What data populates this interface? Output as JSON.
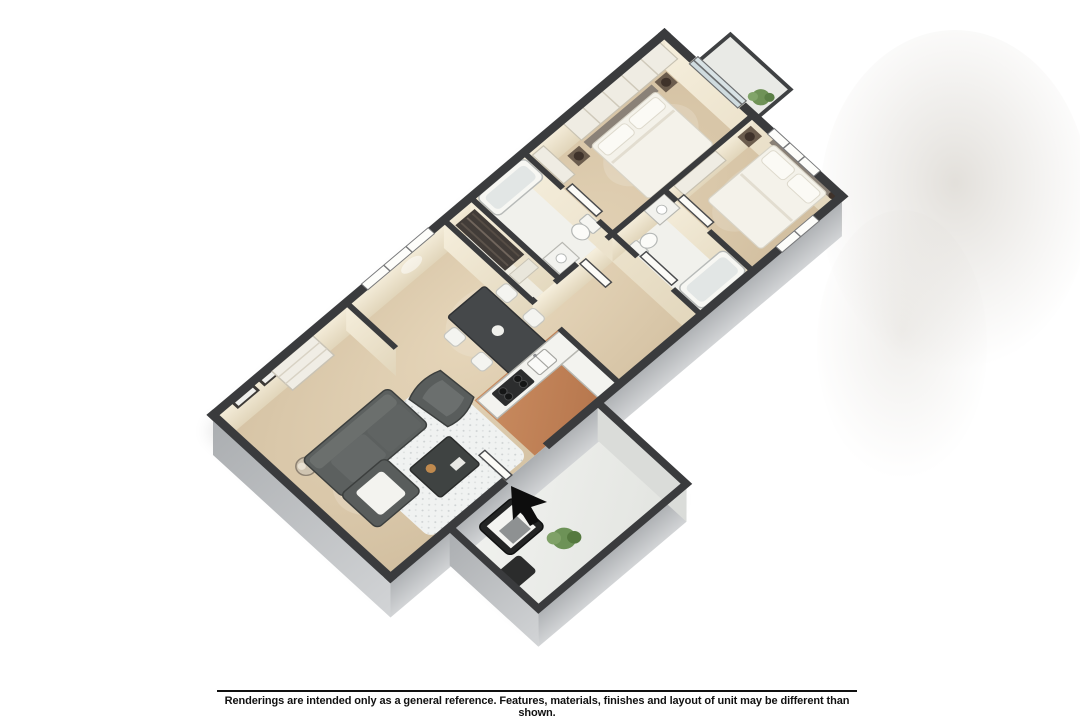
{
  "disclaimer": {
    "text": "Renderings are intended only as a general reference. Features, materials, finishes and layout of unit may be different than shown."
  },
  "floor_plan": {
    "view": "isometric-3d-cutaway-apartment",
    "bedrooms_visible": 2,
    "bathrooms_visible": 2,
    "rooms": [
      {
        "name": "living-room",
        "furniture": [
          "sectional-sofa",
          "accent-chair",
          "coffee-table",
          "area-rug",
          "globe-floor-lamp",
          "wall-art-frames",
          "console-shelf"
        ]
      },
      {
        "name": "dining-area",
        "furniture": [
          "dining-table",
          "dining-chairs-x4"
        ],
        "window": true
      },
      {
        "name": "kitchen",
        "furniture": [
          "l-shaped-counter",
          "cooktop",
          "double-sink"
        ],
        "floor": "terracotta-tile"
      },
      {
        "name": "hall-closet",
        "furniture": [
          "hanging-clothes",
          "linen-shelf"
        ]
      },
      {
        "name": "bathroom-1",
        "furniture": [
          "bathtub",
          "toilet",
          "vanity"
        ]
      },
      {
        "name": "bathroom-2",
        "furniture": [
          "bathtub",
          "toilet",
          "vanity"
        ]
      },
      {
        "name": "bedroom-1",
        "furniture": [
          "bed",
          "nightstands-x2",
          "sphere-lamps",
          "dresser",
          "closet-shelving",
          "sliding-glass-door"
        ]
      },
      {
        "name": "bedroom-2",
        "furniture": [
          "bed",
          "nightstand",
          "sphere-lamps",
          "dresser"
        ],
        "windows": 2
      },
      {
        "name": "patio",
        "furniture": [
          "lounge-chair",
          "ottoman",
          "potted-plant"
        ],
        "entry_marker": "cursor-arrow"
      },
      {
        "name": "balcony",
        "furniture": [
          "potted-plant"
        ],
        "railing": true
      }
    ]
  },
  "colors": {
    "background": "#ffffff",
    "wall_top": "#3a3b3d",
    "wall_face": "#e9dfca",
    "ext_wall": "#b5b8bb",
    "floor_tan": "#d8c5a6",
    "floor_tile": "#c08257",
    "floor_white": "#f1f1ec",
    "patio_floor": "#edefeb",
    "rug": "#f0f2f1",
    "sofa": "#5c605f",
    "dark_table": "#3f4342",
    "white_furniture": "#f3f3ef",
    "bed_linen": "#f4f2ea",
    "wood_dark": "#6b5c4d",
    "plant": "#6f9257",
    "marker": "#0d0d0d",
    "smudge": "#c7c1b7"
  }
}
